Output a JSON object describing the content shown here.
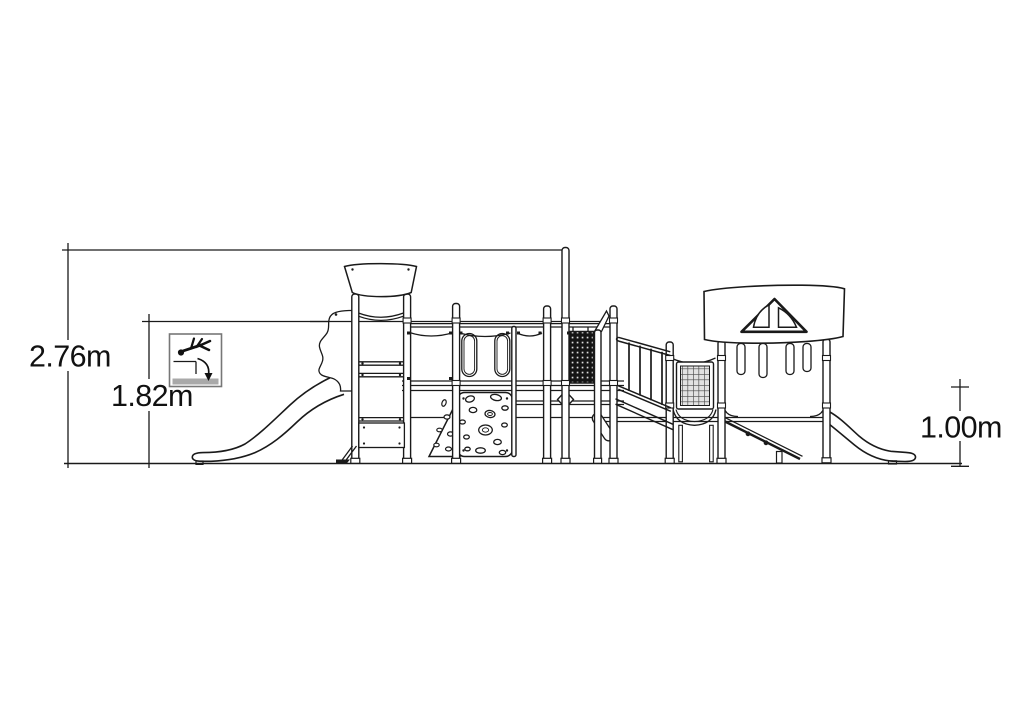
{
  "canvas": {
    "background": "#ffffff",
    "line_color": "#1a1a1a",
    "dim_text_color": "#111111",
    "warning_frame_color": "#777777",
    "warning_bar_color": "#a9a9a9"
  },
  "dimensions": {
    "overall_height": {
      "label": "2.76m"
    },
    "fall_height": {
      "label": "1.82m"
    },
    "right_platform_height": {
      "label": "1.00m"
    }
  },
  "icons": {
    "fall_warning": "falling-person-icon"
  }
}
